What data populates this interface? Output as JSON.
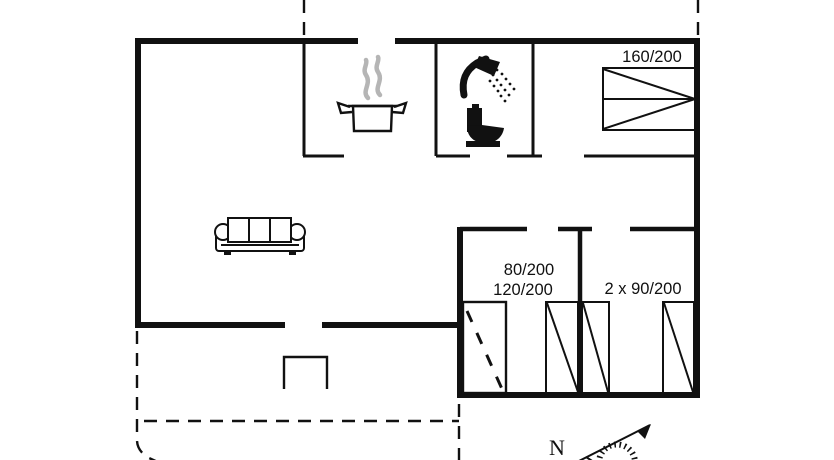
{
  "labels": {
    "double_bed": "160/200",
    "left_bedroom_line1": "80/200",
    "left_bedroom_line2": "120/200",
    "right_bedroom": "2 x 90/200",
    "compass_north": "N"
  },
  "colors": {
    "ink": "#111111",
    "steam_gray": "#b5b5b5",
    "background": "#ffffff"
  },
  "icons": [
    "stove-pot-icon",
    "steam-icon",
    "shower-icon",
    "toilet-icon",
    "double-bed-icon",
    "sofa-icon",
    "wardrobe-icon",
    "single-bed-icon",
    "porch-step-icon",
    "compass-rose-icon"
  ]
}
